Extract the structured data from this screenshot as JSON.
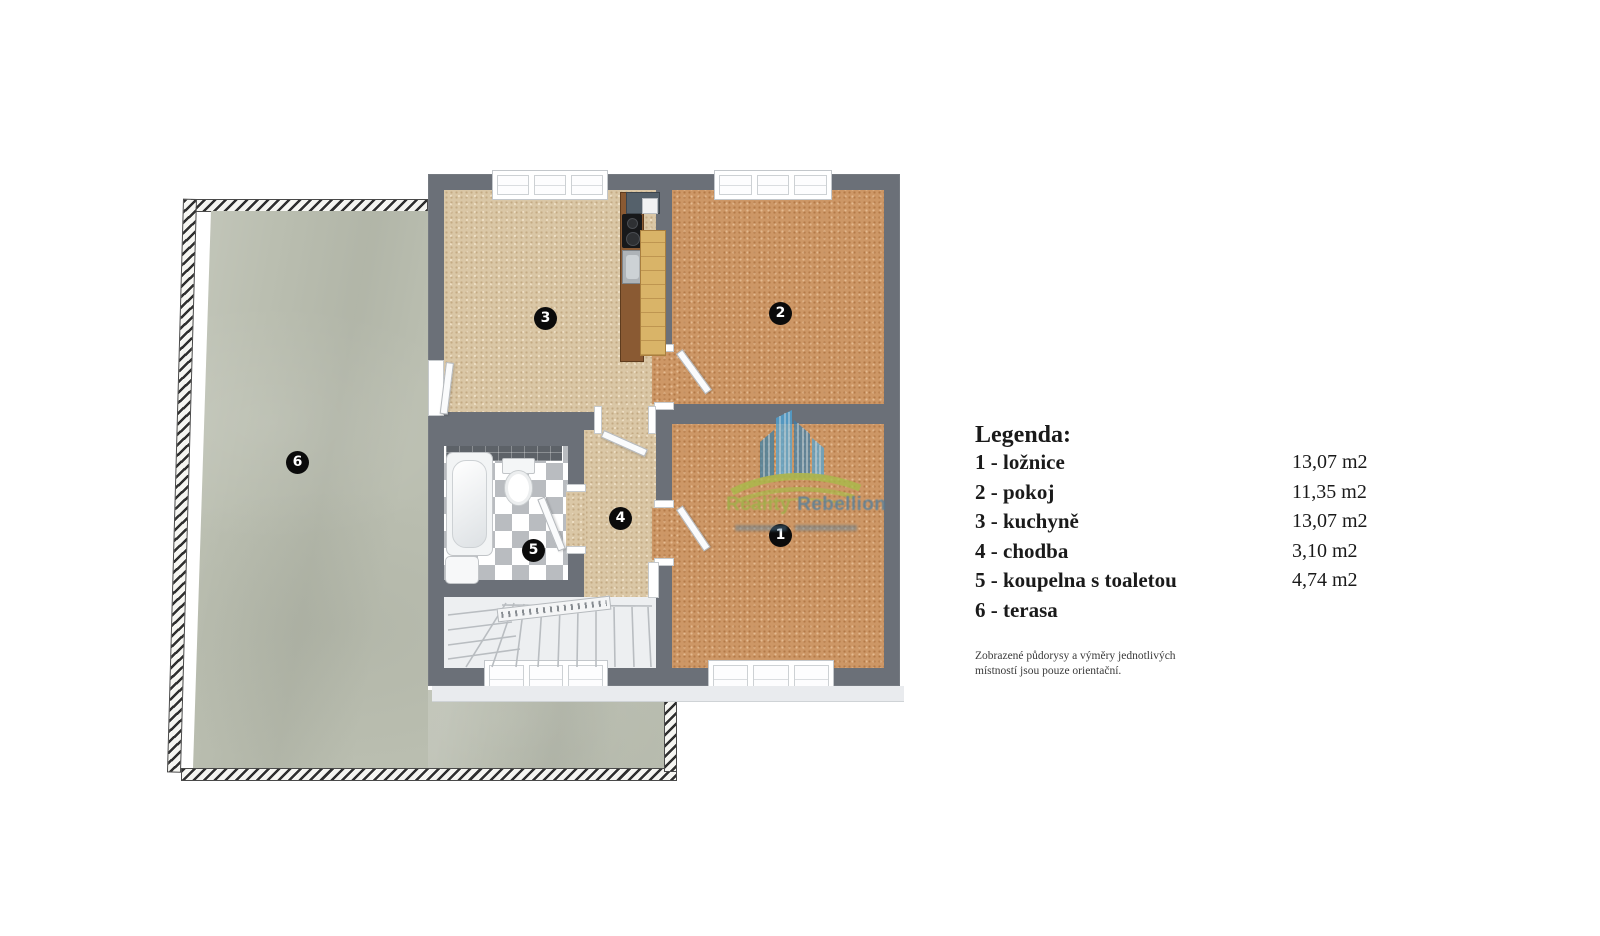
{
  "legend": {
    "title": "Legenda:",
    "items": [
      {
        "num": "1",
        "label": "1 - ložnice",
        "area": "13,07 m2"
      },
      {
        "num": "2",
        "label": "2 - pokoj",
        "area": "11,35 m2"
      },
      {
        "num": "3",
        "label": "3 - kuchyně",
        "area": "13,07 m2"
      },
      {
        "num": "4",
        "label": "4 - chodba",
        "area": "3,10 m2"
      },
      {
        "num": "5",
        "label": "5 - koupelna s toaletou",
        "area": "4,74 m2"
      },
      {
        "num": "6",
        "label": "6 - terasa",
        "area": ""
      }
    ],
    "note_line1": "Zobrazené půdorysy a výměry jednotlivých",
    "note_line2": "místností jsou pouze orientační."
  },
  "watermark": {
    "word1": "Reality",
    "word2": "Rebellion"
  },
  "colors": {
    "wall": "#6b7078",
    "floor_room": "#cd9766",
    "floor_kitchen": "#dac7a6",
    "floor_terrace": "#babeb0",
    "bathroom_tile_dark": "#5d6268",
    "stair_floor": "#edeff1",
    "badge_background": "#0b0b0b",
    "watermark_blue": "#4aa6dc",
    "watermark_green": "#a4bc45"
  }
}
